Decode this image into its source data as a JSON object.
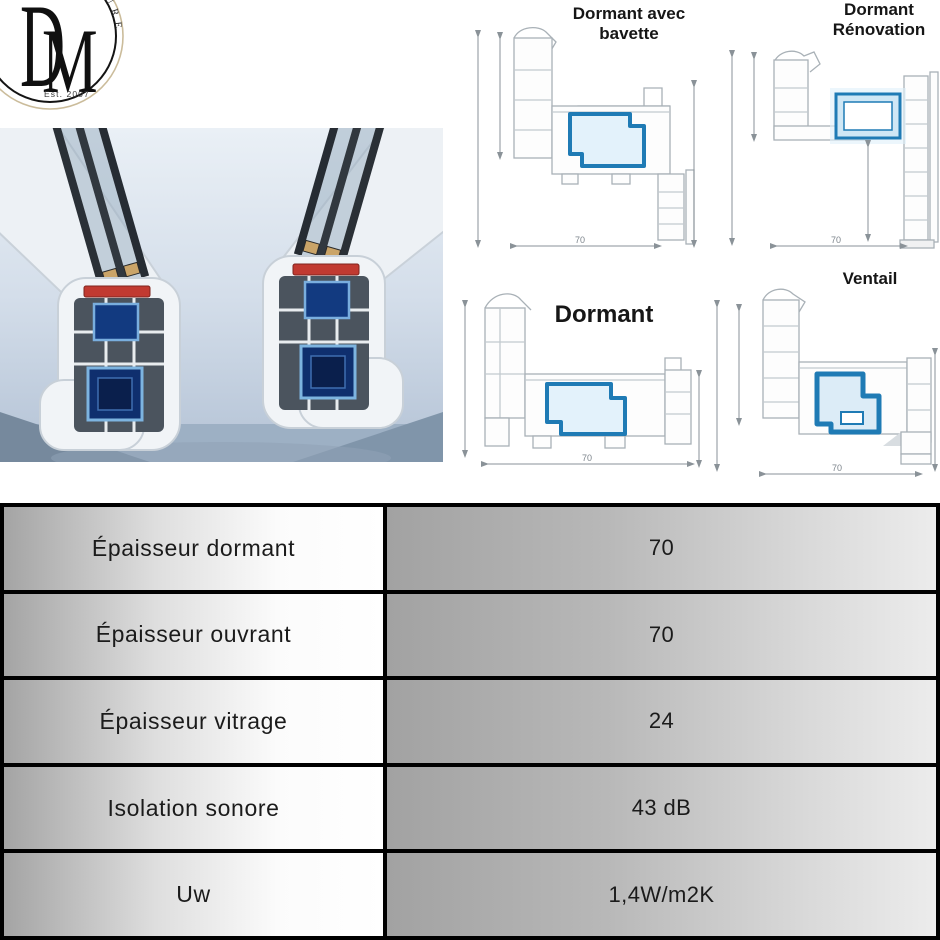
{
  "brand": {
    "monogram_d": "D",
    "monogram_m": "M",
    "arc_text": "ETURES",
    "established": "Est. 2007"
  },
  "drawings": {
    "dormant_avec_bavette": {
      "title": "Dormant avec bavette",
      "width_label": "70"
    },
    "dormant_renovation": {
      "title": "Dormant Rénovation",
      "width_label": "70"
    },
    "dormant": {
      "title": "Dormant",
      "width_label": "70"
    },
    "ventail": {
      "title": "Ventail",
      "width_label": "70"
    }
  },
  "spec_table": {
    "rows": [
      {
        "label": "Épaisseur dormant",
        "value": "70"
      },
      {
        "label": "Épaisseur ouvrant",
        "value": "70"
      },
      {
        "label": "Épaisseur vitrage",
        "value": "24"
      },
      {
        "label": "Isolation sonore",
        "value": "43 dB"
      },
      {
        "label": "Uw",
        "value": "1,4W/m2K"
      }
    ]
  },
  "colors": {
    "steel_blue": "#1f7bb5",
    "reinforcement_fill": "#e3f2fb",
    "gasket_red": "#c13a31",
    "spacer_tan": "#caa468",
    "table_border": "#000000",
    "table_gray": "#a4a4a4",
    "photo_sky": "#d7e0ec",
    "logo_gold_ring": "#cbbc9b"
  }
}
